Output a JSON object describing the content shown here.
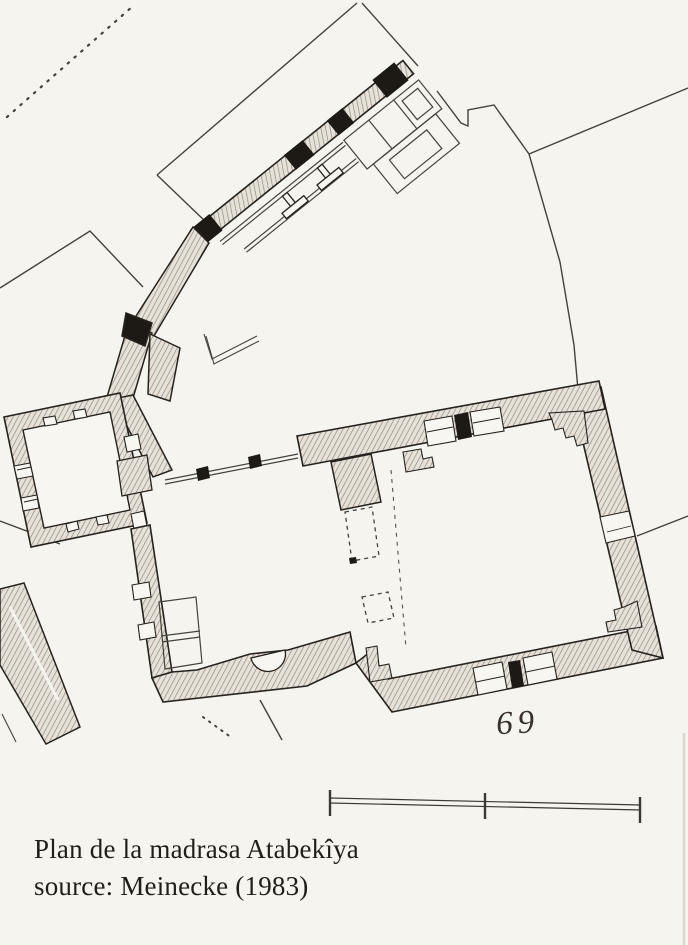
{
  "figure": {
    "number": "69",
    "caption_line1": "Plan de la madrasa Atabekîya",
    "caption_line2": "source: Meinecke (1983)"
  },
  "plan": {
    "type": "architectural-floor-plan",
    "structures": [
      "north-wing-arcade",
      "left-room",
      "courtyard",
      "main-hall",
      "south-wall",
      "site-boundary-lines",
      "detached-wall-strip"
    ],
    "scale_bar": {
      "tick_count": 3,
      "segment_count": 2
    }
  },
  "colors": {
    "paper": "#f6f4ef",
    "ink": "#26221d",
    "wall_hatch_line": "#8a8478",
    "wall_hatch_bg": "#e6e2da",
    "pier_black": "#1d1a15",
    "thin_line": "#45413b"
  }
}
